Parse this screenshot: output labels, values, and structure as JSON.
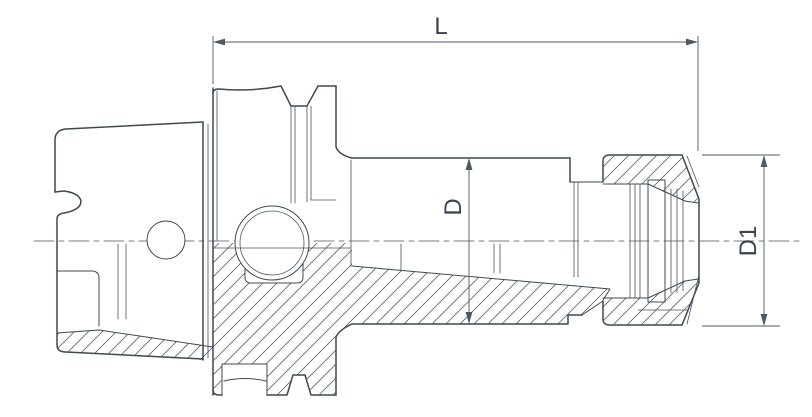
{
  "diagram": {
    "type": "technical-drawing",
    "subject": "HSK collet chuck tool holder, half-section side view",
    "labels": {
      "length": "L",
      "body_diameter": "D",
      "nut_diameter": "D1"
    },
    "colors": {
      "line": "#3d4852",
      "dimension_line": "#4d5862",
      "hatch": "#5a6670",
      "background": "#ffffff"
    }
  }
}
